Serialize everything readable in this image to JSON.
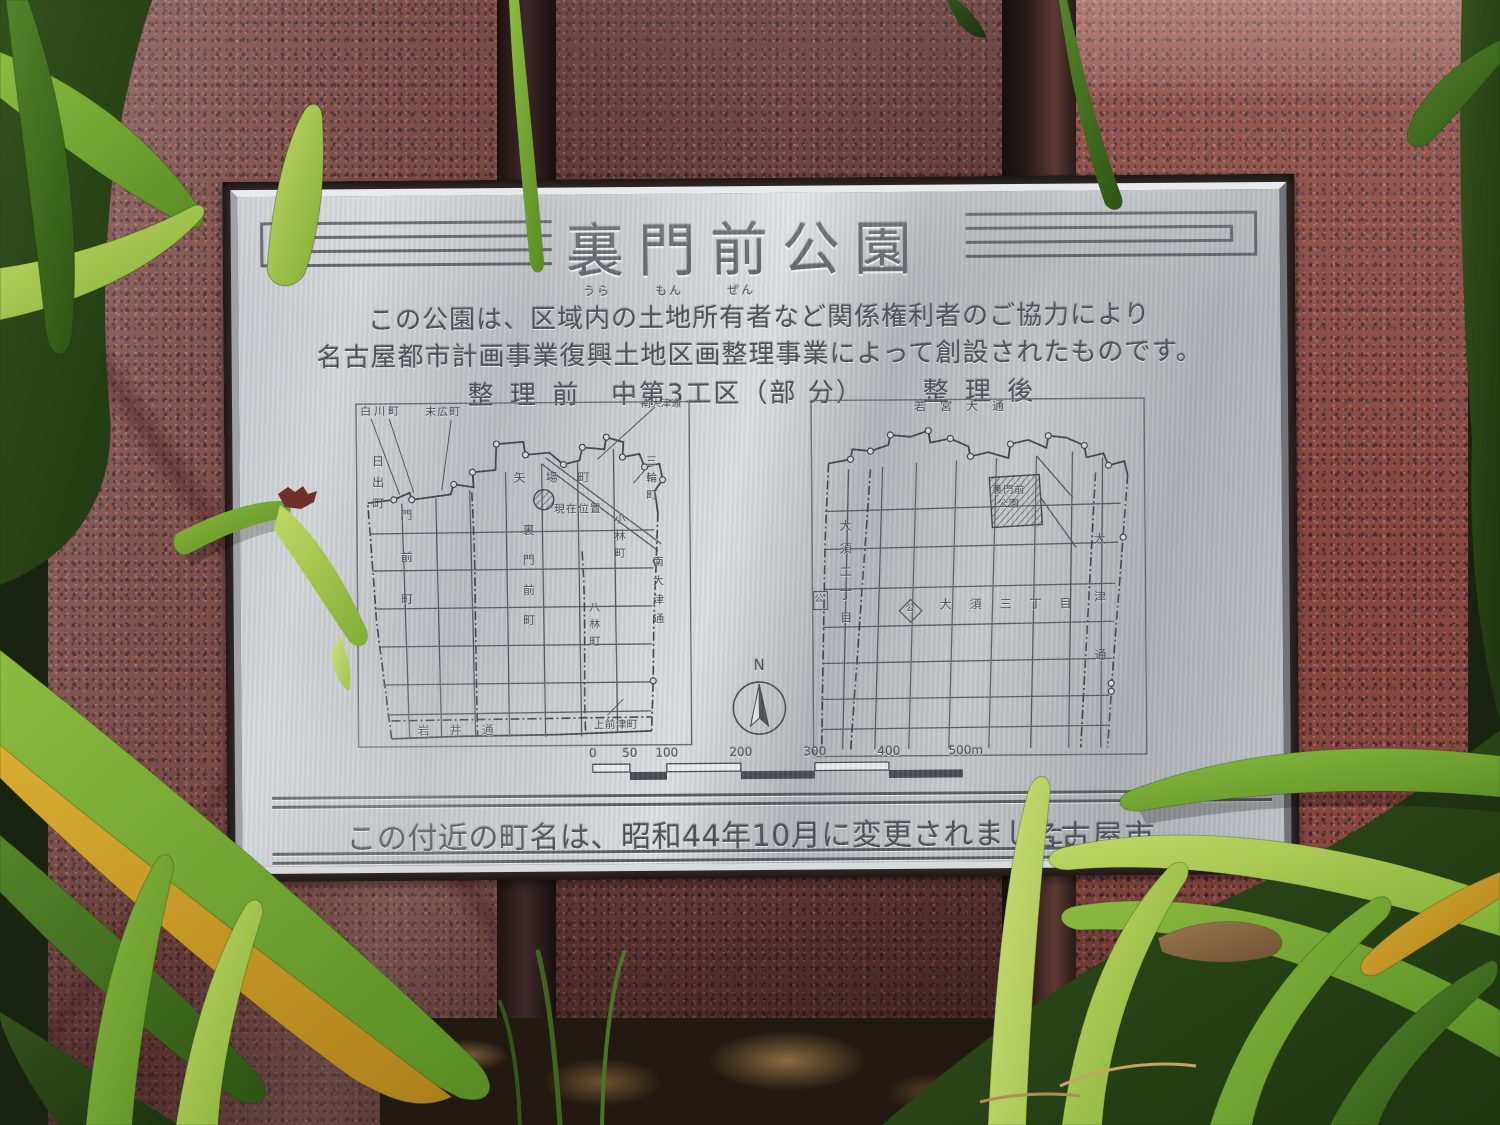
{
  "plaque": {
    "title": "裏門前公園",
    "furigana": [
      "うら",
      "もん",
      "ぜん"
    ],
    "intro": [
      "この公園は、区域内の土地所有者など関係権利者のご協力により",
      "名古屋都市計画事業復興土地区画整理事業によって創設されたものです。"
    ],
    "sections": {
      "before": "整 理 前",
      "district": "中第3工区（部 分）",
      "after": "整 理 後"
    },
    "map_before": {
      "labels": {
        "shirakawa": "白川町",
        "suehiro": "末広町",
        "minami_otsu_dori_top": "南大津通",
        "hinode": "日出町",
        "monzen": "門前町",
        "yaba": "矢場町",
        "genzai_ichi": "現在位置",
        "miwa": "三輪町",
        "kobayashi": "小林町",
        "uramonzen_cho": "裏門前町",
        "hachibayashi": "八林町",
        "minami_otsu_dori": "南大津通",
        "iwai_dori": "岩井通",
        "kamimaezu": "上前津町"
      }
    },
    "map_after": {
      "labels": {
        "wakamiya_odori": "若宮大通",
        "park": "裏門前公園",
        "osu_2chome": "大須二丁目",
        "osu_3chome": "大須三丁目",
        "otsu_dori": "大津通",
        "park_symbol_left": "公",
        "park_symbol": "公"
      }
    },
    "compass": {
      "north": "N"
    },
    "scale": {
      "ticks": [
        "0",
        "50",
        "100",
        "200",
        "300",
        "400",
        "500m"
      ]
    },
    "footer": {
      "notice": "この付近の町名は、昭和44年10月に変更されました。",
      "city": "名古屋市"
    }
  }
}
